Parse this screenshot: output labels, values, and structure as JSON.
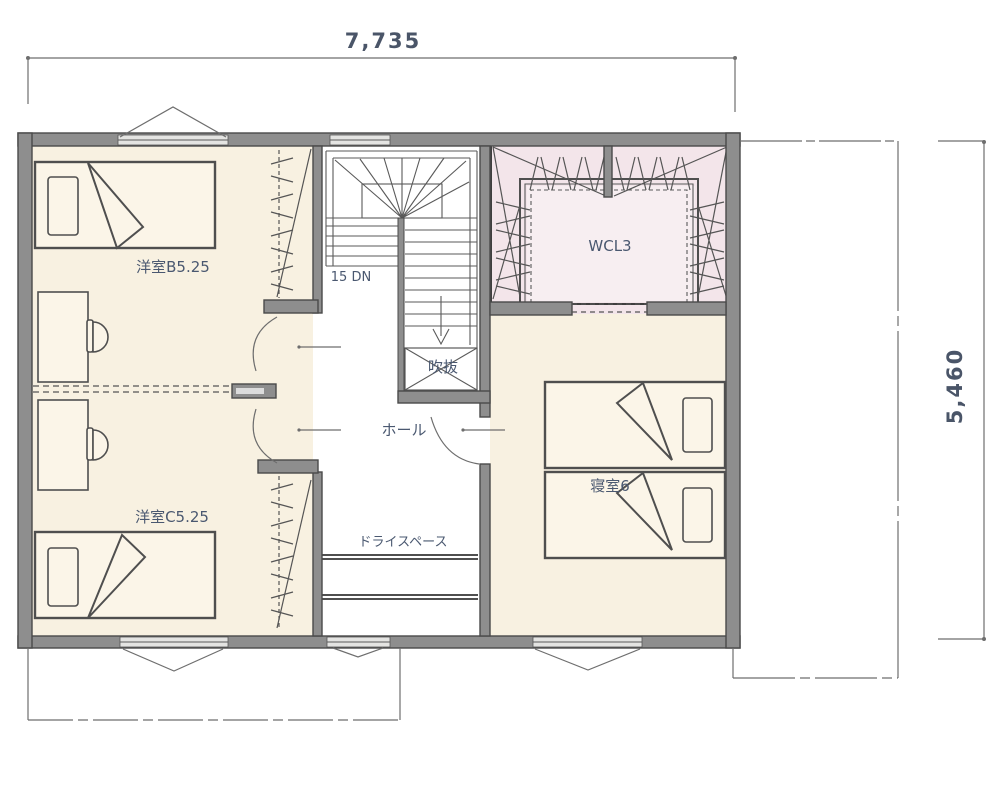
{
  "floor_plan": {
    "dimension_top": "7,735",
    "dimension_right": "5,460",
    "labels": {
      "room_b": "洋室B5.25",
      "room_c": "洋室C5.25",
      "closet": "WCL3",
      "bedroom": "寝室6",
      "hall": "ホール",
      "void": "吹抜",
      "dry_space": "ドライスペース",
      "stair_note": "15 DN"
    },
    "colors": {
      "floor": "#f8f1e1",
      "closet_floor": "#f3e5ea",
      "wall_fill": "#8e8e8e",
      "wall_edge": "#4a4a4a",
      "drawing_line": "#5a5a5a",
      "label_text": "#4a5870",
      "dimension_text": "#4a5568"
    }
  }
}
